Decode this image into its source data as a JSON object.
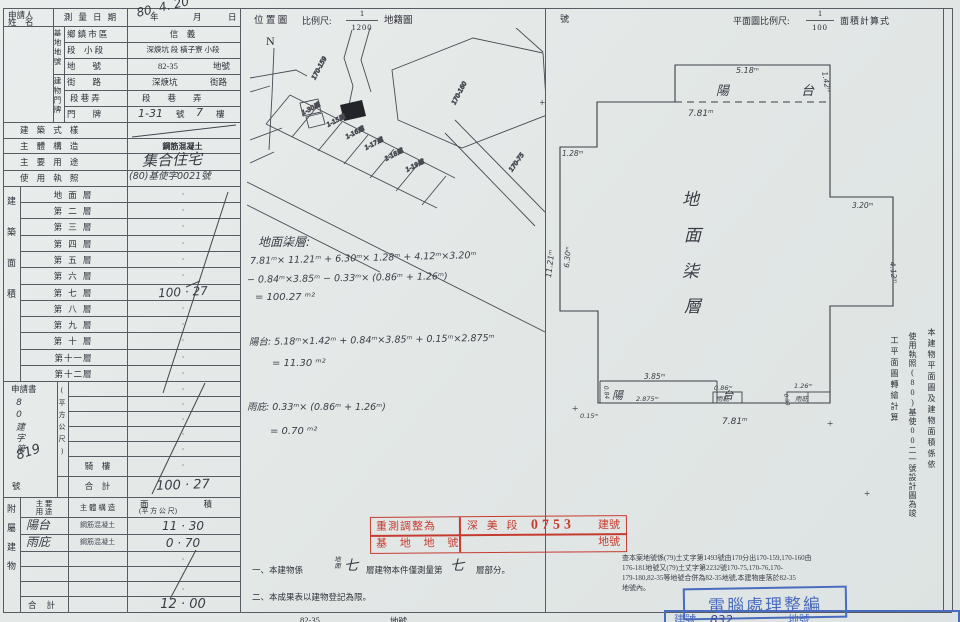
{
  "colors": {
    "paper": "#e5e9e8",
    "ink": "#2e2e37",
    "hand": "#3b3b45",
    "line": "#5a5a62",
    "red": "#c63b30",
    "blue": "#4a6cbe"
  },
  "header": {
    "location_map": "位 置 圖",
    "scale_label": "比例尺:",
    "loc_num": "1",
    "loc_den": "1200",
    "cadastre": "地籍圖",
    "hao": "號",
    "north": "N",
    "plan_scale_label": "平面圖比例尺:",
    "plan_num": "1",
    "plan_den": "100",
    "area_calc": "面積計算式"
  },
  "applicant": {
    "line1": "申請人",
    "line2": "姓　名"
  },
  "survey": {
    "label": "測 量 日 期",
    "hand_date": "80. 4. 20",
    "year": "年",
    "month": "月",
    "day": "日"
  },
  "base": {
    "group": "基地地號",
    "r1_label": "鄉 鎮 市 區",
    "r1_value": "信　義",
    "r2_label": "段　小 段",
    "r2_value": "深焿坑 段 橫子寮 小段",
    "r3_label": "地　　號",
    "r3_value": "82-35",
    "r3_suffix": "地號"
  },
  "door": {
    "group": "建物門牌",
    "r1_label": "街　　路",
    "r1_value": "深焿坑",
    "r1_suffix": "街路",
    "r2_label": "段 巷 弄",
    "r2_value": "段　　巷　　弄",
    "r3_label": "門　　牌",
    "r3_v1": "1-31",
    "r3_s1": "號",
    "r3_v2": "7",
    "r3_s2": "樓"
  },
  "attrs": {
    "style_label": "建 築 式 樣",
    "structure_label": "主 體 構 造",
    "structure_value": "鋼筋混凝土",
    "use_label": "主 要 用 途",
    "use_value": "集合住宅",
    "license_label": "使 用 執 照",
    "license_value": "(80)基使字0021號"
  },
  "area": {
    "group1": "建築面積",
    "group2": "(平方公尺)",
    "floors": [
      {
        "label": "地 面 層",
        "value": "·"
      },
      {
        "label": "第 二 層",
        "value": "·"
      },
      {
        "label": "第 三 層",
        "value": "·"
      },
      {
        "label": "第 四 層",
        "value": "·"
      },
      {
        "label": "第 五 層",
        "value": "·"
      },
      {
        "label": "第 六 層",
        "value": "·"
      },
      {
        "label": "第 七 層",
        "value": "100 · 27"
      },
      {
        "label": "第 八 層",
        "value": "·"
      },
      {
        "label": "第 九 層",
        "value": "·"
      },
      {
        "label": "第 十 層",
        "value": "·"
      },
      {
        "label": "第十一層",
        "value": "·"
      },
      {
        "label": "第十二層",
        "value": "·"
      },
      {
        "label": "",
        "value": "·"
      },
      {
        "label": "",
        "value": "·"
      },
      {
        "label": "",
        "value": "·"
      },
      {
        "label": "",
        "value": "·"
      },
      {
        "label": "",
        "value": "·"
      },
      {
        "label": "騎　樓",
        "value": "·"
      },
      {
        "label": "合　計",
        "value": "100 · 27"
      }
    ]
  },
  "application": {
    "title": "申請書",
    "hand_prefix": "80建字第",
    "hand_no": "819",
    "hao": "號"
  },
  "annex": {
    "group": "附屬建物",
    "h_use1": "主 要",
    "h_use2": "用 途",
    "h_structure": "主 體 構 造",
    "h_area1": "面積",
    "h_area2": "(平 方 公 尺)",
    "rows": [
      {
        "use": "陽台",
        "structure": "鋼筋混凝土",
        "area": "11 · 30"
      },
      {
        "use": "雨庇",
        "structure": "鋼筋混凝土",
        "area": "0 · 70"
      },
      {
        "use": "",
        "structure": "",
        "area": "·"
      },
      {
        "use": "",
        "structure": "",
        "area": "·"
      },
      {
        "use": "",
        "structure": "",
        "area": "·"
      },
      {
        "use": "合 計",
        "structure": "",
        "area": "12 · 00"
      }
    ]
  },
  "calc": {
    "floor_title": "地面柒層:",
    "floor_l1": "7.81ᵐ× 11.21ᵐ + 6.30ᵐ× 1.28ᵐ + 4.12ᵐ×3.20ᵐ",
    "floor_l2": "− 0.84ᵐ×3.85ᵐ − 0.33ᵐ× (0.86ᵐ + 1.26ᵐ)",
    "floor_l3": "= 100.27 ᵐ²",
    "balcony_l1": "陽台: 5.18ᵐ×1.42ᵐ + 0.84ᵐ×3.85ᵐ + 0.15ᵐ×2.875ᵐ",
    "balcony_l2": "= 11.30 ᵐ²",
    "canopy_l1": "雨庇: 0.33ᵐ× (0.86ᵐ + 1.26ᵐ)",
    "canopy_l2": "= 0.70 ᵐ²"
  },
  "stamp": {
    "r1c1": "重測調整為",
    "r1_section": "深 美 段",
    "r1_no": "0753",
    "r1_suffix": "建號",
    "r2c1": "基 地 地 號",
    "r2_suffix": "地號"
  },
  "notes": {
    "n1_a": "一、本建物係",
    "n1_hand_small": "地面",
    "n1_hand1": "七",
    "n1_b": "層建物本件僅測量第",
    "n1_hand2": "七",
    "n1_c": "層部分。",
    "n2": "二、本成果表以建物登記為限。"
  },
  "remark": {
    "l1": "查本案地號係(79)土丈字第1493號由170分出170-159,170-160由",
    "l2": "176-181地號又(79)土丈字第2232號170-75,170-76,170-",
    "l3": "179-180,82-35等地號合併為82-35地號,本建物座落於82-35",
    "l4": "地號內。"
  },
  "computer_stamp": "電腦處理整編",
  "bottom_row": {
    "left1": "82-35",
    "left2": "地號",
    "blue_label": "建號",
    "hand_no": "832",
    "right": "地號"
  },
  "vnote": {
    "c1": "本建物平面圖及建物面積係依",
    "c2": "使用執照(80)基使00二一號設計圖為竣",
    "c3": "工平面圖轉繪計算"
  },
  "plan": {
    "balcony_top": "陽 台",
    "floor_c1": "地",
    "floor_c2": "面",
    "floor_c3": "柒",
    "floor_c4": "層",
    "balcony_bottom": "陽 台",
    "canopy1": "雨庇",
    "canopy2": "雨庇",
    "plus": "+",
    "dims": {
      "d518": "5.18ᵐ",
      "d142": "1.42ᵐ",
      "d781t": "7.81ᵐ",
      "d128": "1.28ᵐ",
      "d630": "6.30ᵐ",
      "d1121": "11.21ᵐ",
      "d320": "3.20ᵐ",
      "d412": "4.12ᵐ",
      "d385": "3.85ᵐ",
      "d2875": "2.875ᵐ",
      "d015": "0.15ᵐ",
      "d084": "0.84",
      "d086": "0.86ᵐ",
      "d126": "1.26ᵐ",
      "d033": "0.33",
      "d781b": "7.81ᵐ"
    }
  },
  "site": {
    "p1": "170-159",
    "p2": "170-160",
    "p3": "170-75",
    "lot1": "1-30建",
    "lot2": "1-15建",
    "lot3": "1-16建",
    "lot4": "1-17建",
    "lot5": "1-18建",
    "lot6": "1-19建"
  }
}
